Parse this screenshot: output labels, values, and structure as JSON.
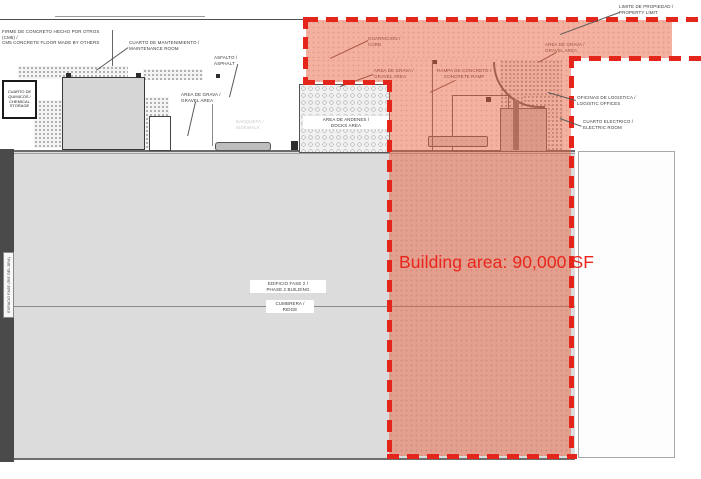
{
  "drawing": {
    "type": "architectural-site-plan",
    "callout": {
      "text": "Building area: 90,000 SF"
    },
    "colors": {
      "highlight_dash_red": "#e3251c",
      "callout_red": "#e9251c",
      "overlay_pink": "rgba(235,100,66,0.5)",
      "building_gray": "#dcdcdc",
      "dark_side_bar": "#4a4a4a",
      "paper_white": "#ffffff"
    },
    "labels": {
      "concrete_floor_note": {
        "l1": "FIRME DE CONCRETO HECHO POR OTROS",
        "l2": "(CM5) /",
        "l3": "CM5 CONCRETE FLOOR MADE BY OTHERS"
      },
      "maintenance_room": {
        "l1": "CUARTO DE MANTENIMIENTO /",
        "l2": "MAINTENANCE ROOM"
      },
      "asphalt": {
        "l1": "ASFALTO /",
        "l2": "ASPHALT"
      },
      "chemical_storage": {
        "l1": "CUARTO DE",
        "l2": "QUIMICOS /",
        "l3": "CHEMICAL",
        "l4": "STORAGE"
      },
      "gravel_left": {
        "l1": "AREA DE GRAVA /",
        "l2": "GRAVEL AREA"
      },
      "docks_area": {
        "l1": "AREA DE ANDENES /",
        "l2": "DOCKS AREA"
      },
      "sidewalk": {
        "l1": "BANQUETA /",
        "l2": "SIDEWALK"
      },
      "curb": {
        "l1": "GUARNICION /",
        "l2": "CURB"
      },
      "gravel_mid": {
        "l1": "AREA DE GRAVA /",
        "l2": "GRAVEL AREA"
      },
      "concrete_ramp": {
        "l1": "RAMPA DE CONCRETO /",
        "l2": "CONCRETE RAMP"
      },
      "gravel_right": {
        "l1": "AREA DE GRAVA /",
        "l2": "GRAVEL AREA"
      },
      "property_limit": {
        "l1": "LIMITE DE PROPIEDAD /",
        "l2": "PROPERTY LIMIT"
      },
      "logistic_offices": {
        "l1": "OFICINAS DE LOGISTICA /",
        "l2": "LOGISTIC OFFICES"
      },
      "electric_room": {
        "l1": "CUARTO ELECTRICO /",
        "l2": "ELECTRIC ROOM"
      },
      "phase2_building": {
        "l1": "EDIFICIO FASE 2 /",
        "l2": "PHASE 2 BUILDING"
      },
      "ridge": {
        "l1": "CUMBRERA /",
        "l2": "RIDGE"
      },
      "side_strip": {
        "l1": "ESPACIO FASE (RIE DEL DRA)"
      }
    }
  }
}
